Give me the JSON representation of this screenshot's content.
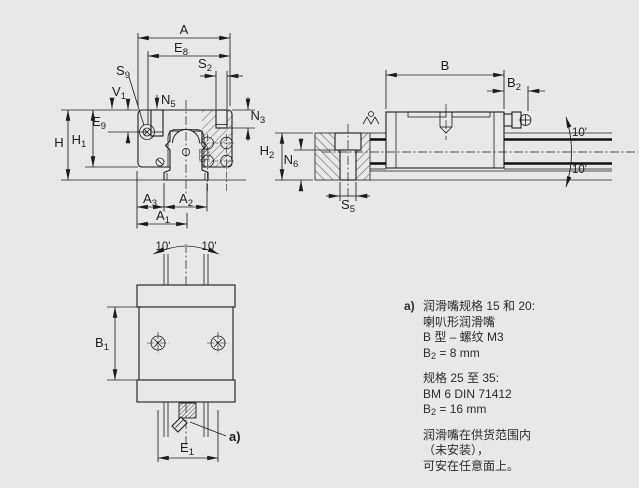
{
  "colors": {
    "background": "#e8e8e8",
    "line": "#1c1c1c",
    "text": "#2b2b2b"
  },
  "dims": {
    "A": {
      "main": "A",
      "sub": ""
    },
    "E8": {
      "main": "E",
      "sub": "8"
    },
    "S2": {
      "main": "S",
      "sub": "2"
    },
    "S9": {
      "main": "S",
      "sub": "9"
    },
    "V1": {
      "main": "V",
      "sub": "1"
    },
    "N5": {
      "main": "N",
      "sub": "5"
    },
    "N3": {
      "main": "N",
      "sub": "3"
    },
    "E9": {
      "main": "E",
      "sub": "9"
    },
    "H": {
      "main": "H",
      "sub": ""
    },
    "H1": {
      "main": "H",
      "sub": "1"
    },
    "A3": {
      "main": "A",
      "sub": "3"
    },
    "A2": {
      "main": "A",
      "sub": "2"
    },
    "A1": {
      "main": "A",
      "sub": "1"
    },
    "B": {
      "main": "B",
      "sub": ""
    },
    "B2": {
      "main": "B",
      "sub": "2"
    },
    "H2": {
      "main": "H",
      "sub": "2"
    },
    "N6": {
      "main": "N",
      "sub": "6"
    },
    "S5": {
      "main": "S",
      "sub": "5"
    },
    "B1": {
      "main": "B",
      "sub": "1"
    },
    "E1": {
      "main": "E",
      "sub": "1"
    }
  },
  "angles": {
    "side_upper": "10'",
    "side_lower": "10'",
    "top_left": "10'",
    "top_right": "10'"
  },
  "callout": {
    "marker": "a)"
  },
  "note": {
    "marker": "a)",
    "groups": [
      {
        "lines": [
          {
            "text": "润滑嘴规格 15 和 20:"
          },
          {
            "text": "喇叭形润滑嘴"
          },
          {
            "text": "B 型 – 螺纹 M3"
          },
          {
            "pre": "B",
            "sub": "2",
            "post": " = 8 mm"
          }
        ]
      },
      {
        "lines": [
          {
            "text": "规格 25 至 35:"
          },
          {
            "text": "BM 6 DIN 71412"
          },
          {
            "pre": "B",
            "sub": "2",
            "post": " = 16 mm"
          }
        ]
      },
      {
        "lines": [
          {
            "text": "润滑嘴在供货范围内"
          },
          {
            "text": "（未安装），"
          },
          {
            "text": "可安在任意面上。"
          }
        ]
      }
    ]
  }
}
